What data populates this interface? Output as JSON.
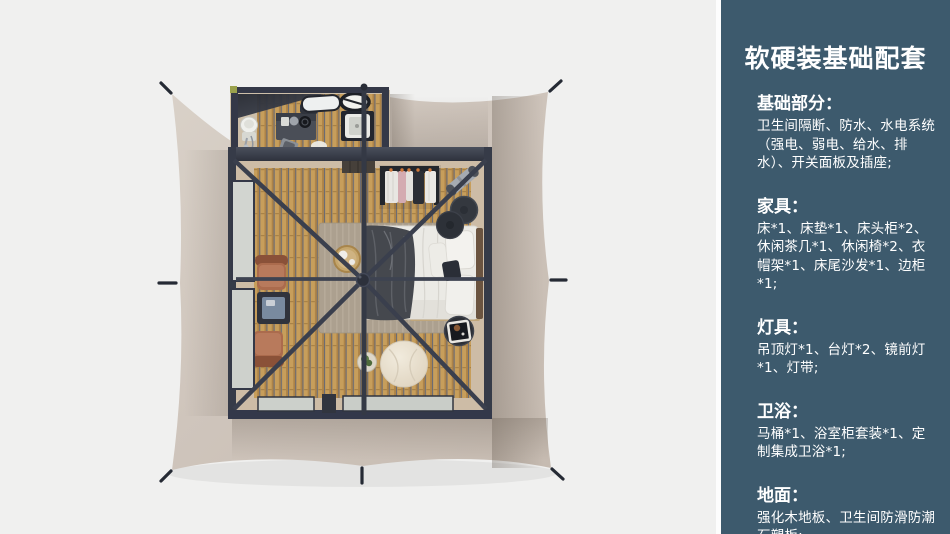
{
  "panel": {
    "accent_color": "#3d5a6d",
    "text_color": "#ffffff",
    "title": "软硬装基础配套",
    "sections": [
      {
        "heading": "基础部分：",
        "body": "卫生间隔断、防水、水电系统（强电、弱电、给水、排水）、开关面板及插座;"
      },
      {
        "heading": "家具：",
        "body": "床*1、床垫*1、床头柜*2、休闲茶几*1、休闲椅*2、衣帽架*1、床尾沙发*1、边柜*1;"
      },
      {
        "heading": "灯具：",
        "body": "吊顶灯*1、台灯*2、镜前灯*1、灯带;"
      },
      {
        "heading": "卫浴：",
        "body": "马桶*1、浴室柜套装*1、定制集成卫浴*1;"
      },
      {
        "heading": "地面：",
        "body": "强化木地板、卫生间防滑防潮石塑板;"
      }
    ]
  },
  "scene": {
    "description": "Top-down 3D rendering of a safari glamping tent: beige stretched canvas, dark steel frame, bedroom with bed, wardrobe rack, lounge chairs, bean bag, and an attached bathroom annex",
    "canvas_color": "#cfc5bc",
    "frame_color": "#363b48",
    "wood_floor_color": "#c79e5b",
    "rug_color": "#aca08f",
    "background_color": "#f0f0ef"
  }
}
